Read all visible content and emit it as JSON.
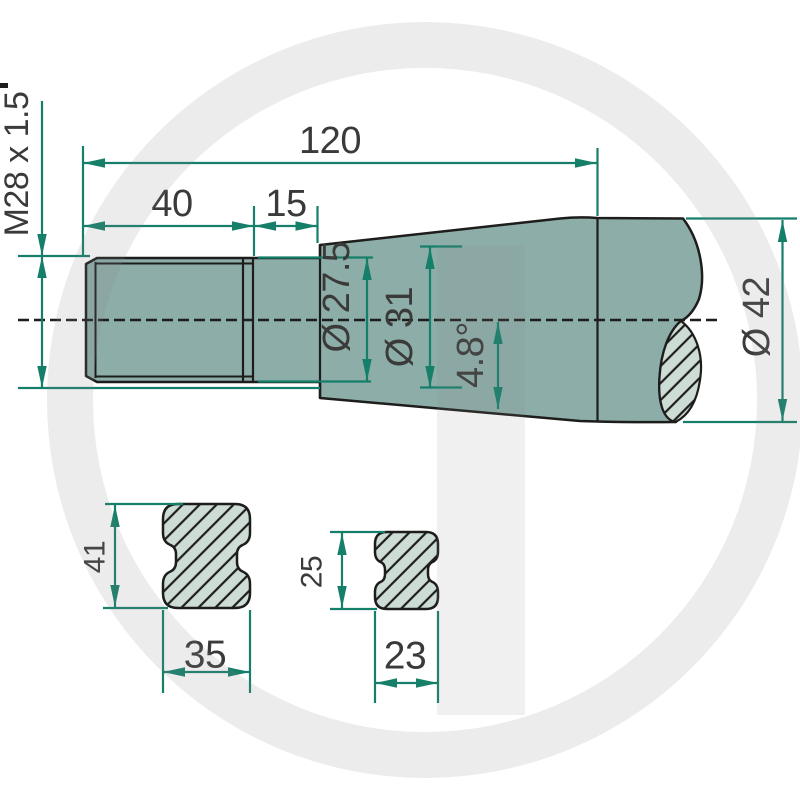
{
  "labels": {
    "overall_length": "120",
    "thread_length": "40",
    "neck_length": "15",
    "thread_spec": "M28 x 1.5",
    "neck_diameter": "Ø 27.5",
    "cone_diameter": "Ø 31",
    "cone_angle": "4.8°",
    "shaft_diameter": "Ø 42",
    "section_left_height": "41",
    "section_left_width": "35",
    "section_right_height": "25",
    "section_right_width": "23"
  },
  "colors": {
    "dimension": "#157f6a",
    "body_fill": "#8dada9",
    "section_fill": "#cedcd6",
    "outline": "#1d1d1b",
    "text": "#3a3a38",
    "watermark": "#888888"
  }
}
